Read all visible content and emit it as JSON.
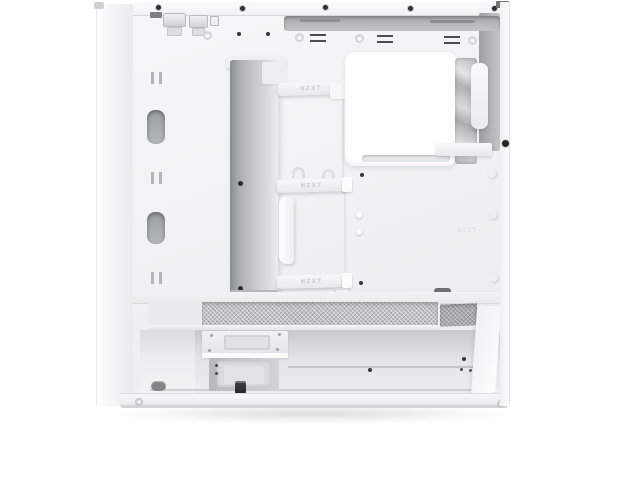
{
  "photo": {
    "subject": "White mid-tower PC case interior, side panel removed",
    "view": "left-side interior product photo on white background",
    "background_color": "#ffffff"
  },
  "branding": {
    "cable_strap_top": "NZXT",
    "cable_strap_middle": "NZXT",
    "cable_strap_bottom": "NZXT",
    "panel_emboss": "NZXT"
  },
  "colors": {
    "case_white": "#f2f3f4",
    "bright_panel": "#fefefe",
    "cable_channel_gray": "#9aa0a4",
    "recess_gray": "#b0b4b7",
    "mesh_gray": "#c4c7ca",
    "screw_black": "#2d2f31",
    "drop_shadow": "rgba(0,0,0,0.14)"
  }
}
